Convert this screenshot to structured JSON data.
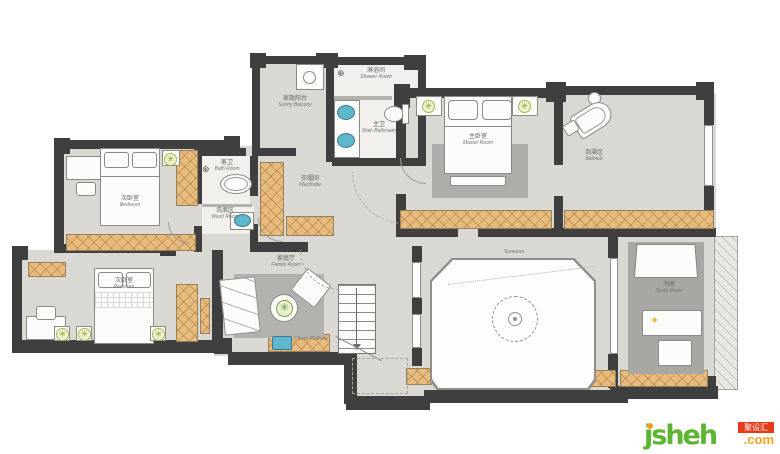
{
  "labels": {
    "laundry": {
      "zh": "家政阳台",
      "en": "Sunny Balcony"
    },
    "shower": {
      "zh": "淋浴间",
      "en": "Shower Room"
    },
    "master_bath": {
      "zh": "主卫",
      "en": "Main Bathroom"
    },
    "master": {
      "zh": "主卧室",
      "en": "Master Room"
    },
    "bathtub": {
      "zh": "泡澡区",
      "en": "Bathtub"
    },
    "cloak": {
      "zh": "衣帽间",
      "en": "Wardrobe"
    },
    "guest_bath": {
      "zh": "客卫",
      "en": "Bath Room"
    },
    "wash": {
      "zh": "洗漱区",
      "en": "Wash Room"
    },
    "bedroom1": {
      "zh": "次卧室",
      "en": "Bedroom"
    },
    "bedroom2": {
      "zh": "次卧室",
      "en": "Bedroom"
    },
    "family": {
      "zh": "家庭厅",
      "en": "Family Room"
    },
    "sunroom": {
      "en": "Sunroom"
    },
    "study": {
      "zh": "书房",
      "en": "Study Room"
    },
    "platform": {
      "en": "Closet Platform"
    }
  },
  "icons": {
    "shower_glyph": "⊕",
    "lamp_glyph": "✳",
    "plant_glyph": "✳",
    "desk_lamp_glyph": "✦"
  },
  "colors": {
    "wall": "#3f3f3f",
    "floor": "#d9d8d3",
    "cabinet": "#e6bb7d",
    "fixture_blue": "#5fb7cd",
    "lamp_green": "#a6b545",
    "brand_green": "#5cb531",
    "brand_orange": "#f5a21d",
    "brand_red": "#e8391a"
  },
  "watermark": {
    "brand": "jsheh",
    "tld": ".com",
    "badge": "聚设汇"
  }
}
